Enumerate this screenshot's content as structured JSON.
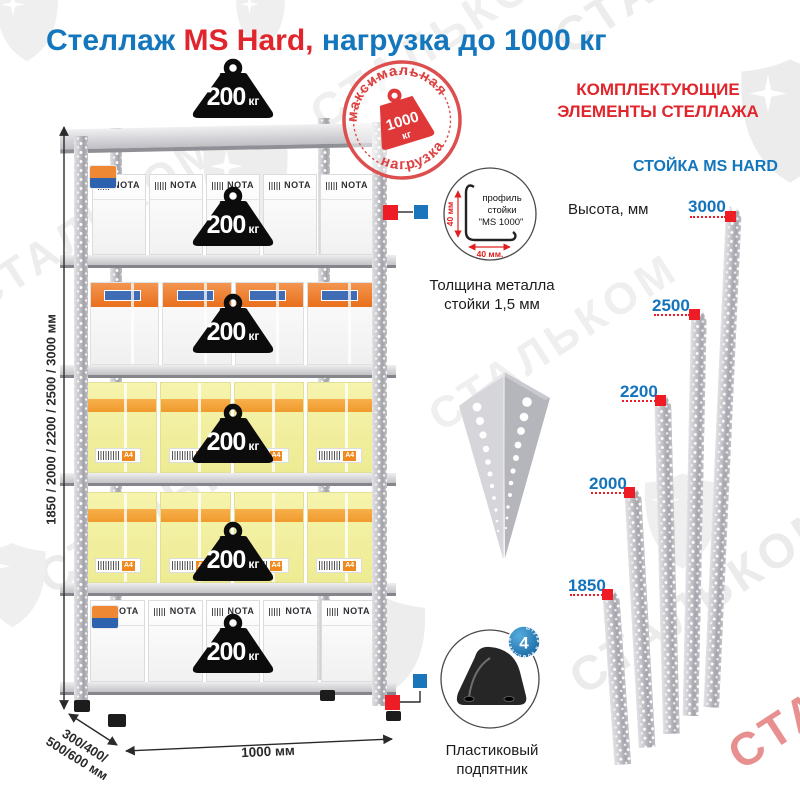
{
  "title": {
    "product": "Стеллаж",
    "model": "MS Hard,",
    "load": "нагрузка до 1000 кг"
  },
  "stamp": {
    "arc_top": "максимальная",
    "arc_bottom": "нагрузка",
    "value": "1000",
    "unit": "кг"
  },
  "weight": {
    "value": "200",
    "unit": "кг"
  },
  "dimensions": {
    "height_range": "1850 / 2000 / 2200 / 2500 / 3000 мм",
    "depth_line1": "300/400/",
    "depth_line2": "500/600 мм",
    "width": "1000 мм"
  },
  "boxes": {
    "brand": "NOTA",
    "paper_size": "A4"
  },
  "profile": {
    "label_line1": "профиль",
    "label_line2": "стойки",
    "label_line3": "\"MS 1000\"",
    "dim_vertical": "40 мм",
    "dim_horizontal": "40 мм.",
    "caption_line1": "Толщина металла",
    "caption_line2": "стойки 1,5 мм"
  },
  "foot": {
    "badge_count": "4",
    "badge_text": "штуки в комплекте",
    "caption_line1": "Пластиковый",
    "caption_line2": "подпятник"
  },
  "components": {
    "header_line1": "КОМПЛЕКТУЮЩИЕ",
    "header_line2": "ЭЛЕМЕНТЫ СТЕЛЛАЖА",
    "post_title": "СТОЙКА MS HARD",
    "height_label": "Высота, мм",
    "heights": [
      "3000",
      "2500",
      "2200",
      "2000",
      "1850"
    ]
  },
  "watermark": {
    "text": "СТАЛЬКОМ"
  },
  "colors": {
    "blue": "#1477bd",
    "red": "#e0262c",
    "marker_red": "#ee1c24",
    "marker_blue": "#1b75bb"
  }
}
